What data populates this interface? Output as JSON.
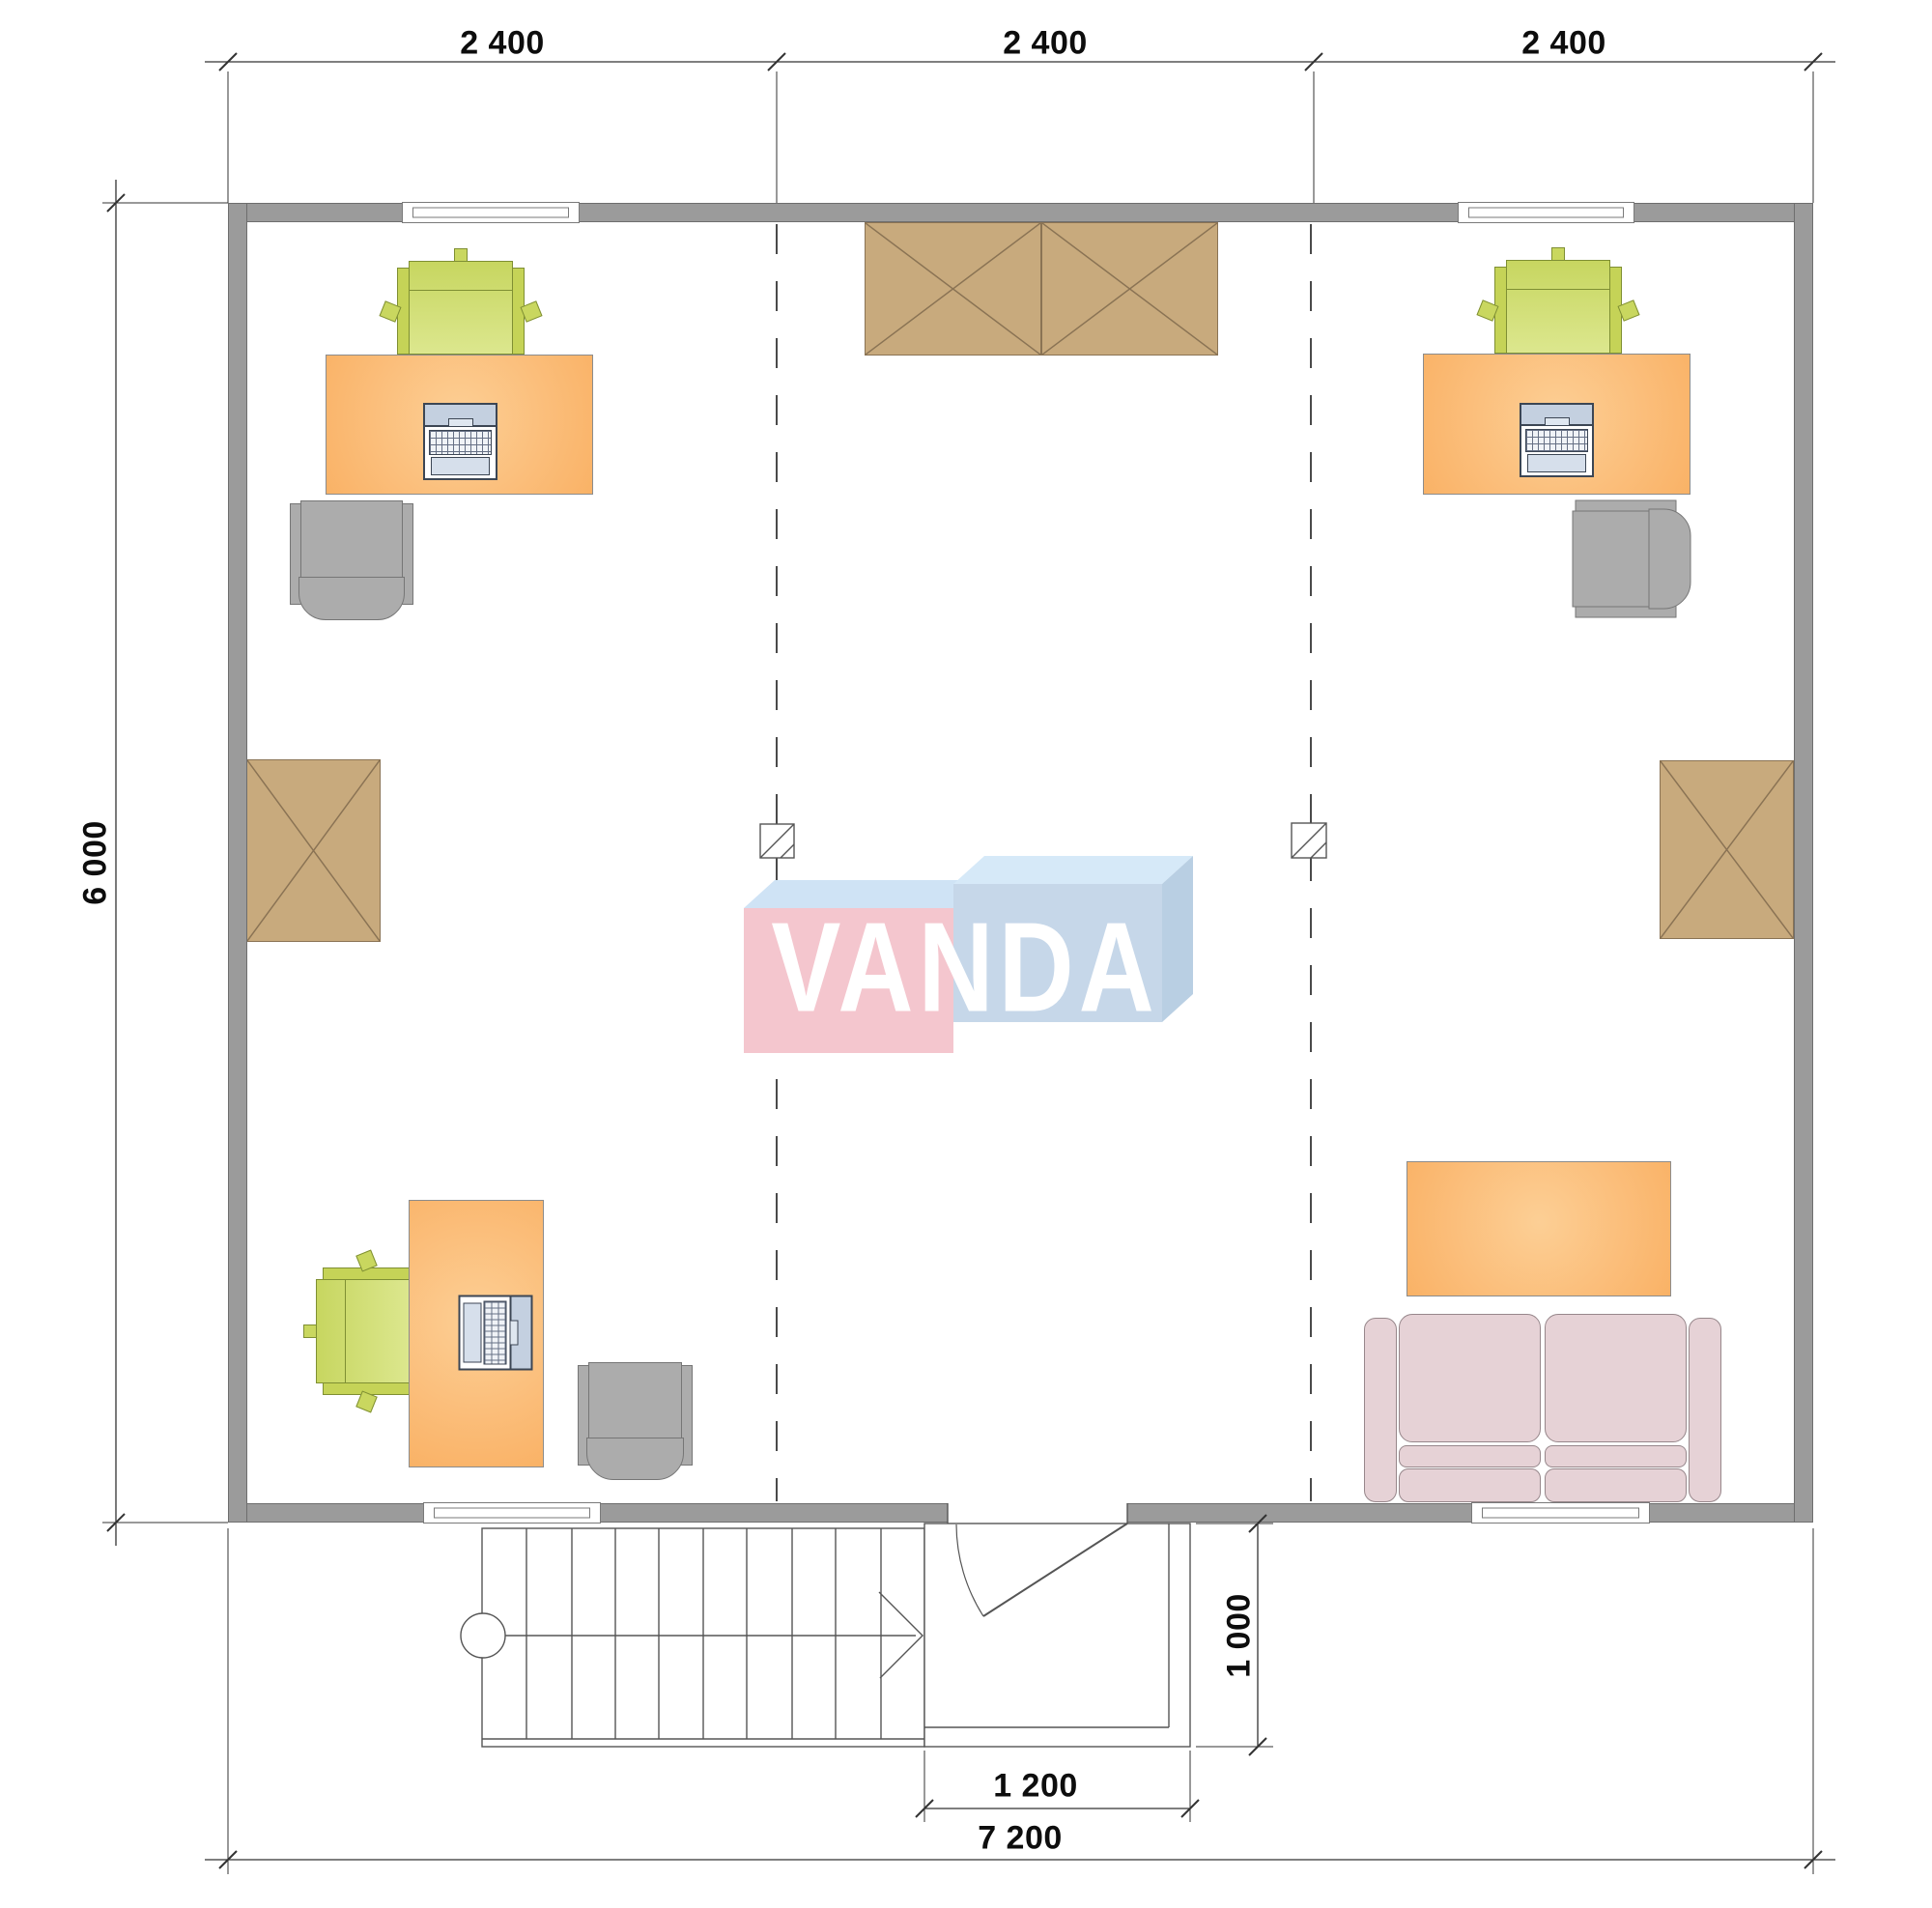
{
  "drawing": {
    "kind": "architectural floor plan",
    "watermark": "VANDA"
  },
  "dimensions": {
    "top_segments": [
      "2 400",
      "2 400",
      "2 400"
    ],
    "side_height": "6 000",
    "total_width": "7 200",
    "entrance_width": "1 200",
    "porch_depth": "1 000"
  },
  "logo": {
    "text": "VANDA",
    "pink": "#f4c6ce",
    "pink_top": "#cfe3f5",
    "blue_front": "#c6d7e9",
    "blue_top": "#d6e9f8",
    "blue_side": "#b9cfe3",
    "text_color": "#ffffff"
  },
  "colors": {
    "wall": "#9b9b9b",
    "desk": "#fbbd79",
    "chair_green": "#c9d75f",
    "chair_gray": "#acacac",
    "storage_box": "#c8aa7d",
    "sofa": "#e6d2d6",
    "laptop_screen": "#c4d0e0",
    "dimension_text": "#0d0d0d"
  }
}
